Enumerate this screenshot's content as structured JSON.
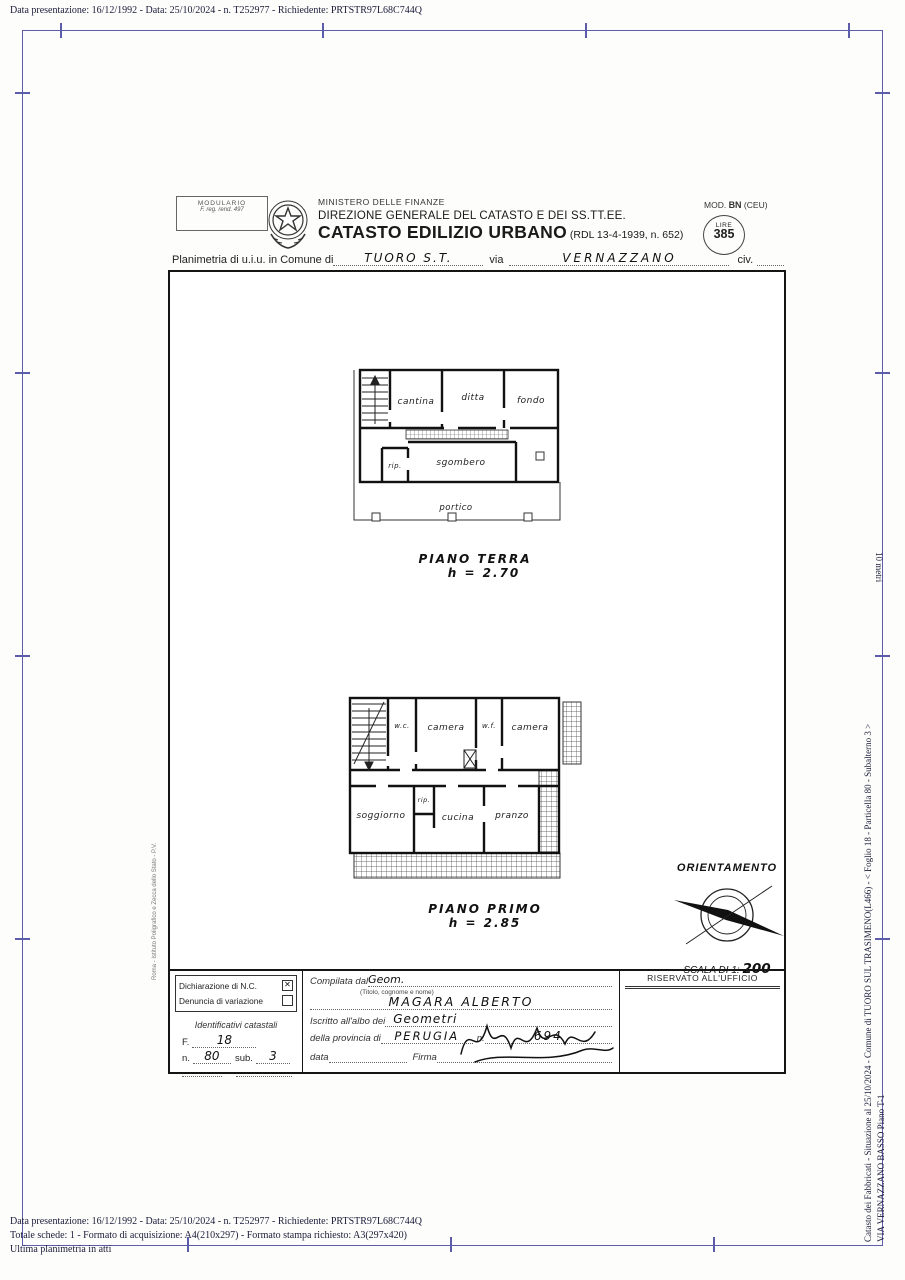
{
  "margin": {
    "top_line": "Data presentazione: 16/12/1992 - Data: 25/10/2024 - n. T252977 - Richiedente: PRTSTR97L68C744Q",
    "bottom_line1": "Data presentazione: 16/12/1992 - Data: 25/10/2024 - n. T252977 - Richiedente: PRTSTR97L68C744Q",
    "bottom_line2": "Totale schede: 1 - Formato di acquisizione: A4(210x297)  - Formato stampa richiesto: A3(297x420)",
    "bottom_line3": "Ultima planimetria in atti",
    "right_line1": "Catasto dei Fabbricati - Situazione al 25/10/2024 - Comune di TUORO SUL TRASIMENO(L466) - < Foglio 18 - Particella 80 - Subalterno 3 >",
    "right_line2": "VIA VERNAZZANO BASSO Piano T-1",
    "scale_ruler": "10 metri"
  },
  "header": {
    "modulario_line1": "MODULARIO",
    "modulario_line2": "F. reg. rend. 497",
    "ministry": "MINISTERO DELLE FINANZE",
    "direction": "DIREZIONE GENERALE DEL CATASTO E DEI SS.TT.EE.",
    "title": "CATASTO EDILIZIO URBANO",
    "title_suffix": " (RDL 13-4-1939, n. 652)",
    "mod_label": "MOD. ",
    "mod_bold": "BN",
    "mod_suffix": " (CEU)",
    "stamp_top": "LIRE",
    "stamp_value": "385"
  },
  "intestazione": {
    "label_comune": "Planimetria di u.i.u. in Comune di",
    "comune_value": "TUORO  S.T.",
    "label_via": "via",
    "via_value": "VERNAZZANO",
    "label_civ": "civ."
  },
  "plans": {
    "ground": {
      "rooms": {
        "cantina": "cantina",
        "ditta": "ditta",
        "fondo": "fondo",
        "rip": "rip.",
        "sgombero": "sgombero",
        "portico": "portico"
      },
      "caption_line1": "PIANO TERRA",
      "caption_line2": "h = 2.70"
    },
    "first": {
      "rooms": {
        "wc": "w.c.",
        "camera1": "camera",
        "wf": "w.f.",
        "camera2": "camera",
        "soggiorno": "soggiorno",
        "rip": "rip.",
        "cucina": "cucina",
        "pranzo": "pranzo"
      },
      "caption_line1": "PIANO PRIMO",
      "caption_line2": "h = 2.85"
    },
    "side_print": "Roma - Istituto Poligrafico e Zecca dello Stato - P.V."
  },
  "orientation": {
    "title": "ORIENTAMENTO",
    "scale_label": "SCALA DI 1: ",
    "scale_value": "200"
  },
  "form": {
    "dichiarazione_label": "Dichiarazione di N.C.",
    "dichiarazione_mark": "✕",
    "denuncia_label": "Denuncia di  variazione",
    "identificativi_title": "Identificativi catastali",
    "f_label": "F.",
    "f_value": "18",
    "n_label": "n.",
    "n_value": "80",
    "sub_label": "sub.",
    "sub_value": "3",
    "compilata_label": "Compilata dal ",
    "compilata_value": "Geom.",
    "titolo_note": "(Titolo, cognome e nome)",
    "nome_value": "MAGARA  ALBERTO",
    "iscritto_label": "Iscritto all'albo dei ",
    "albo_value": "Geometri",
    "provincia_label": "della provincia di ",
    "provincia_value": "PERUGIA",
    "num_label": "n.",
    "num_value": "694",
    "data_label": "data",
    "firma_label": "Firma",
    "riservato": "RISERVATO ALL'UFFICIO"
  }
}
